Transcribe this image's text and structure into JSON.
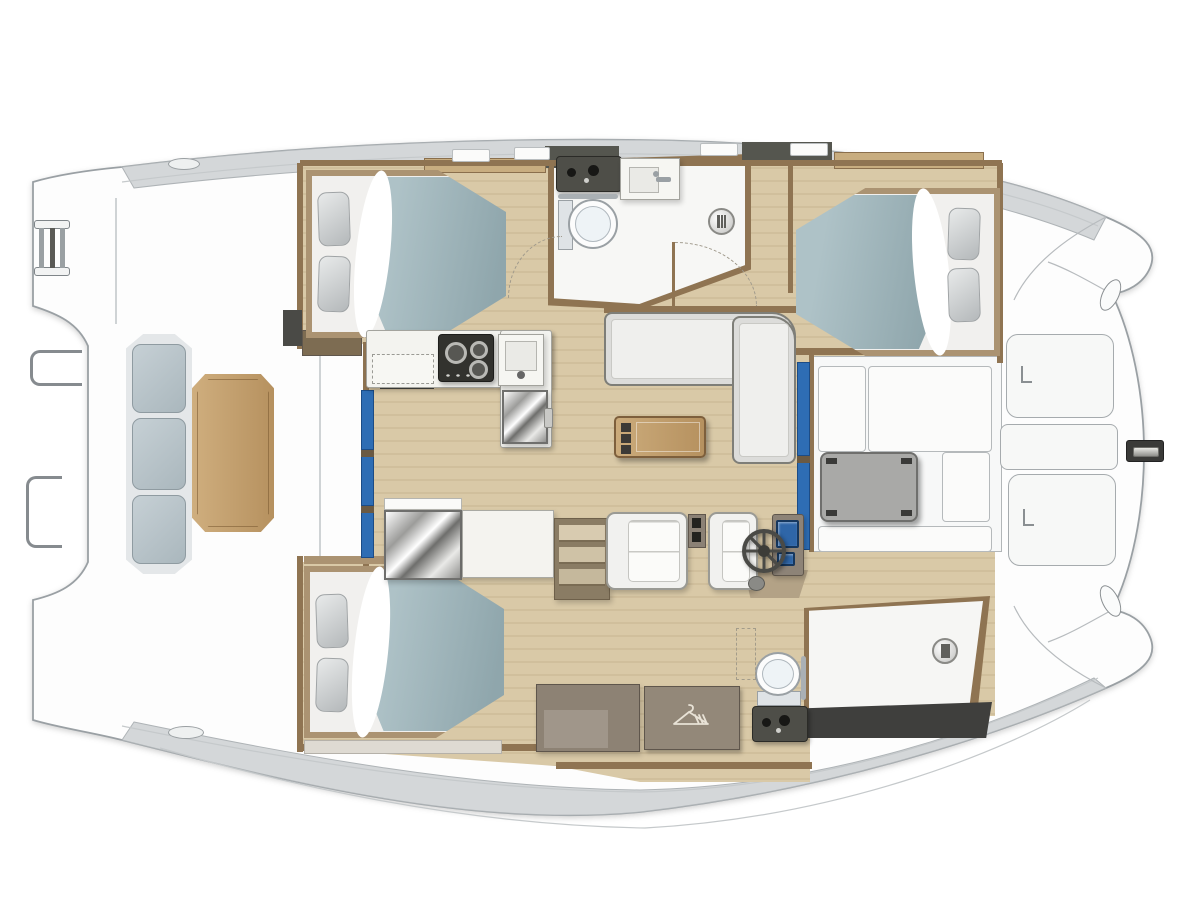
{
  "palette": {
    "page_bg": "#ffffff",
    "hull_fill": "#fdfdfd",
    "hull_stroke": "#9aa0a4",
    "band": "#d4d7d9",
    "band_stroke": "#aeb3b6",
    "deck_line": "#c5c9cb",
    "wood_a": "#d9c9a7",
    "wood_b": "#d0bf9c",
    "trim": "#8f7452",
    "trim_dark": "#6b5a43",
    "counter": "#f3f3ef",
    "blue_door": "#2e6db4",
    "blue_door_dark": "#1c4c86",
    "duvet_l": "#aec2c7",
    "duvet_d": "#8fa6ac",
    "mattress": "#f1f0ee",
    "bed_trim": "#ab9372",
    "pillow_l": "#e8eaea",
    "pillow_d": "#b4b8ba",
    "sofa": "#efefed",
    "woodtab_l": "#cfae7e",
    "woodtab_d": "#b6915f",
    "dark_fixture": "#3a3a38",
    "white_floor": "#f7f7f5",
    "speckle": "#e8e8e4"
  },
  "elements": [
    {
      "id": "salon-wood-floor",
      "t": "rect",
      "x": 0,
      "y": 0,
      "w": 1200,
      "h": 900,
      "cls": "wood",
      "z": 1,
      "clip": "polygon(300px 165px,1000px 165px,1000px 360px,814px 360px,814px 550px,995px 550px,995px 716px,810px 716px,810px 782px,640px 782px,556px 766px,300px 748px,300px 562px,366px 562px,366px 344px,300px 344px)"
    },
    {
      "id": "bathroom-wall",
      "t": "rect",
      "x": 548,
      "y": 154,
      "w": 203,
      "h": 156,
      "fill": "#8f7452",
      "z": 2,
      "clip": "polygon(0 4%,100% 0,100% 74%,45% 100%,0 97%)"
    },
    {
      "id": "bathroom-floor",
      "t": "rect",
      "x": 553,
      "y": 160,
      "w": 192,
      "h": 144,
      "fill": "#f7f7f5",
      "cls": "speckle",
      "z": 3,
      "clip": "polygon(0 3%,100% 0,100% 73%,45% 100%,0 96%)"
    },
    {
      "id": "bow-cockpit-floor",
      "t": "rect",
      "x": 812,
      "y": 356,
      "w": 190,
      "h": 196,
      "fill": "#f7f8f8",
      "stroke": "#b2b6b8",
      "cls": "speckle",
      "z": 2
    },
    {
      "id": "shower-wall",
      "t": "rect",
      "x": 804,
      "y": 596,
      "w": 186,
      "h": 120,
      "fill": "#8f7452",
      "z": 2,
      "clip": "polygon(0 10%,100% 0,93% 100%,0 100%)"
    },
    {
      "id": "shower-floor",
      "t": "rect",
      "x": 809,
      "y": 601,
      "w": 174,
      "h": 108,
      "fill": "#f6f6f4",
      "cls": "speckle",
      "z": 3,
      "clip": "polygon(0 9%,100% 0,92% 100%,0 100%)"
    },
    {
      "id": "wall-top",
      "t": "rect",
      "x": 300,
      "y": 160,
      "w": 702,
      "h": 6,
      "fill": "#8f7452",
      "z": 4
    },
    {
      "id": "wall-left-fwd",
      "t": "rect",
      "x": 297,
      "y": 163,
      "w": 6,
      "h": 186,
      "fill": "#8f7452",
      "z": 4
    },
    {
      "id": "wall-left-mid",
      "t": "rect",
      "x": 363,
      "y": 342,
      "w": 6,
      "h": 224,
      "fill": "#8f7452",
      "z": 4
    },
    {
      "id": "wall-left-aft",
      "t": "rect",
      "x": 297,
      "y": 556,
      "w": 6,
      "h": 196,
      "fill": "#8f7452",
      "z": 4
    },
    {
      "id": "wall-right-cabin",
      "t": "rect",
      "x": 997,
      "y": 163,
      "w": 6,
      "h": 200,
      "fill": "#8f7452",
      "z": 4
    },
    {
      "id": "wall-bath-left",
      "t": "rect",
      "x": 549,
      "y": 163,
      "w": 5,
      "h": 140,
      "fill": "#8f7452",
      "z": 4
    },
    {
      "id": "wall-sofa-back",
      "t": "rect",
      "x": 604,
      "y": 306,
      "w": 194,
      "h": 7,
      "fill": "#8f7452",
      "z": 4
    },
    {
      "id": "wall-cockpit-left",
      "t": "rect",
      "x": 809,
      "y": 354,
      "w": 5,
      "h": 198,
      "fill": "#8f7452",
      "z": 4
    },
    {
      "id": "wall-corridor-right",
      "t": "rect",
      "x": 788,
      "y": 163,
      "w": 5,
      "h": 130,
      "fill": "#8f7452",
      "z": 4
    },
    {
      "id": "wall-under-stbd-bed",
      "t": "rect",
      "x": 793,
      "y": 348,
      "w": 209,
      "h": 7,
      "fill": "#8f7452",
      "z": 4
    },
    {
      "id": "wall-bottom-port",
      "t": "rect",
      "x": 300,
      "y": 744,
      "w": 260,
      "h": 7,
      "fill": "#8f7452",
      "z": 4
    },
    {
      "id": "wall-bottom-mid",
      "t": "rect",
      "x": 556,
      "y": 762,
      "w": 256,
      "h": 7,
      "fill": "#8f7452",
      "z": 4
    },
    {
      "id": "wall-aft-bed-head",
      "t": "rect",
      "x": 304,
      "y": 556,
      "w": 200,
      "h": 8,
      "fill": "#ab9372",
      "z": 4
    },
    {
      "id": "cabinet-by-galley",
      "t": "rect",
      "x": 302,
      "y": 330,
      "w": 60,
      "h": 26,
      "fill": "#7d6c52",
      "stroke": "#5f564c",
      "z": 5
    },
    {
      "id": "oven-front",
      "t": "rect",
      "x": 380,
      "y": 378,
      "w": 54,
      "h": 11,
      "fill": "#45453f",
      "z": 5
    },
    {
      "id": "companionway-dark",
      "t": "rect",
      "x": 283,
      "y": 310,
      "w": 19,
      "h": 36,
      "fill": "#4a4a46",
      "z": 4
    },
    {
      "id": "deck-seam-1",
      "t": "rect",
      "x": 319,
      "y": 334,
      "w": 2,
      "h": 226,
      "fill": "#cfd3d5",
      "z": 1
    },
    {
      "id": "deck-seam-2",
      "t": "rect",
      "x": 115,
      "y": 198,
      "w": 2,
      "h": 126,
      "fill": "#cfd3d5",
      "z": 1
    },
    {
      "id": "sliding-door-port-1",
      "t": "rect",
      "x": 361,
      "y": 390,
      "w": 13,
      "h": 60,
      "fill": "#2e6db4",
      "stroke": "#1c4c86",
      "z": 5
    },
    {
      "id": "sliding-door-port-2",
      "t": "rect",
      "x": 361,
      "y": 456,
      "w": 13,
      "h": 50,
      "fill": "#2e6db4",
      "stroke": "#1c4c86",
      "z": 5
    },
    {
      "id": "sliding-door-port-3",
      "t": "rect",
      "x": 361,
      "y": 512,
      "w": 13,
      "h": 46,
      "fill": "#2e6db4",
      "stroke": "#1c4c86",
      "z": 5
    },
    {
      "id": "door-sep-1",
      "t": "rect",
      "x": 361,
      "y": 450,
      "w": 13,
      "h": 7,
      "fill": "#6b5a43",
      "z": 6
    },
    {
      "id": "door-sep-2",
      "t": "rect",
      "x": 361,
      "y": 506,
      "w": 13,
      "h": 7,
      "fill": "#6b5a43",
      "z": 6
    },
    {
      "id": "sliding-door-stbd-1",
      "t": "rect",
      "x": 797,
      "y": 362,
      "w": 13,
      "h": 94,
      "fill": "#2e6db4",
      "stroke": "#1c4c86",
      "z": 5
    },
    {
      "id": "sliding-door-stbd-2",
      "t": "rect",
      "x": 797,
      "y": 462,
      "w": 13,
      "h": 88,
      "fill": "#2e6db4",
      "stroke": "#1c4c86",
      "z": 5
    },
    {
      "id": "door-sep-3",
      "t": "rect",
      "x": 797,
      "y": 456,
      "w": 13,
      "h": 7,
      "fill": "#6b5a43",
      "z": 6
    },
    {
      "id": "roof-dark-seg-1",
      "t": "rect",
      "x": 545,
      "y": 146,
      "w": 74,
      "h": 22,
      "fill": "#55564f",
      "z": 3
    },
    {
      "id": "roof-dark-seg-2",
      "t": "rect",
      "x": 742,
      "y": 142,
      "w": 90,
      "h": 22,
      "fill": "#55564f",
      "z": 3
    },
    {
      "id": "roof-tan-seg-1",
      "t": "rect",
      "x": 424,
      "y": 158,
      "w": 122,
      "h": 15,
      "fill": "#c8ad80",
      "stroke": "#8a6f4d",
      "z": 3
    },
    {
      "id": "roof-tan-seg-2",
      "t": "rect",
      "x": 834,
      "y": 152,
      "w": 150,
      "h": 17,
      "fill": "#c8ad80",
      "stroke": "#8a6f4d",
      "z": 3
    },
    {
      "id": "roof-hatch-1",
      "t": "rect",
      "x": 452,
      "y": 149,
      "w": 38,
      "h": 13,
      "fill": "#fbfbfa",
      "stroke": "#b9bdbf",
      "r": 2,
      "z": 4
    },
    {
      "id": "roof-hatch-2",
      "t": "rect",
      "x": 514,
      "y": 147,
      "w": 36,
      "h": 13,
      "fill": "#fbfbfa",
      "stroke": "#b9bdbf",
      "r": 2,
      "z": 4
    },
    {
      "id": "roof-hatch-3",
      "t": "rect",
      "x": 700,
      "y": 143,
      "w": 38,
      "h": 13,
      "fill": "#fbfbfa",
      "stroke": "#b9bdbf",
      "r": 2,
      "z": 4
    },
    {
      "id": "roof-hatch-4",
      "t": "rect",
      "x": 790,
      "y": 143,
      "w": 38,
      "h": 13,
      "fill": "#fbfbfa",
      "stroke": "#b9bdbf",
      "r": 2,
      "z": 4
    },
    {
      "id": "cleat-aft-top",
      "t": "oval",
      "x": 168,
      "y": 158,
      "w": 32,
      "h": 12,
      "fill": "#eef0f0",
      "stroke": "#9a9fa2",
      "z": 4
    },
    {
      "id": "cleat-aft-bottom",
      "t": "oval",
      "x": 168,
      "y": 726,
      "w": 36,
      "h": 13,
      "fill": "#eef0f0",
      "stroke": "#9a9fa2",
      "z": 4
    },
    {
      "id": "scupper-bow-top",
      "t": "oval",
      "x": 1102,
      "y": 278,
      "w": 17,
      "h": 34,
      "fill": "#fafbfb",
      "stroke": "#8a8f92",
      "rot": 26,
      "z": 4
    },
    {
      "id": "scupper-bow-bottom",
      "t": "oval",
      "x": 1102,
      "y": 584,
      "w": 17,
      "h": 34,
      "fill": "#fafbfb",
      "stroke": "#8a8f92",
      "rot": -26,
      "z": 4
    },
    {
      "id": "bed-forward-port",
      "t": "bed",
      "x": 306,
      "y": 170,
      "w": 200,
      "h": 168,
      "dir": "right",
      "z": 5
    },
    {
      "id": "pillow-fp-1",
      "t": "pillow",
      "x": 318,
      "y": 192,
      "w": 32,
      "h": 54,
      "rot": -2,
      "z": 6
    },
    {
      "id": "pillow-fp-2",
      "t": "pillow",
      "x": 318,
      "y": 256,
      "w": 32,
      "h": 56,
      "rot": 2,
      "z": 6
    },
    {
      "id": "bed-forward-stbd",
      "t": "bed",
      "x": 796,
      "y": 188,
      "w": 204,
      "h": 168,
      "dir": "left",
      "z": 5
    },
    {
      "id": "pillow-fs-1",
      "t": "pillow",
      "x": 948,
      "y": 208,
      "w": 32,
      "h": 52,
      "rot": 2,
      "z": 6
    },
    {
      "id": "pillow-fs-2",
      "t": "pillow",
      "x": 948,
      "y": 268,
      "w": 32,
      "h": 54,
      "rot": -2,
      "z": 6
    },
    {
      "id": "bed-aft-port",
      "t": "bed",
      "x": 304,
      "y": 566,
      "w": 200,
      "h": 172,
      "dir": "right",
      "z": 5
    },
    {
      "id": "pillow-ap-1",
      "t": "pillow",
      "x": 316,
      "y": 594,
      "w": 32,
      "h": 54,
      "rot": -2,
      "z": 6
    },
    {
      "id": "pillow-ap-2",
      "t": "pillow",
      "x": 316,
      "y": 658,
      "w": 32,
      "h": 54,
      "rot": 2,
      "z": 6
    },
    {
      "id": "shelf-aft-port",
      "t": "rect",
      "x": 304,
      "y": 740,
      "w": 198,
      "h": 14,
      "fill": "#dedad2",
      "stroke": "#b5b1a9",
      "z": 4
    },
    {
      "id": "galley-counter",
      "t": "rect",
      "x": 366,
      "y": 330,
      "w": 186,
      "h": 58,
      "fill": "#f3f3ef",
      "stroke": "#a3a39d",
      "r": 3,
      "cls": "shadow",
      "z": 5
    },
    {
      "id": "galley-counter-return",
      "t": "rect",
      "x": 500,
      "y": 330,
      "w": 52,
      "h": 118,
      "fill": "#f3f3ef",
      "stroke": "#a3a39d",
      "r": 3,
      "cls": "shadow",
      "z": 5
    },
    {
      "id": "galley-worktop-dashed",
      "t": "rect",
      "x": 372,
      "y": 354,
      "w": 62,
      "h": 30,
      "fill": "#f7f7f3",
      "stroke": "#9a9a94",
      "dash": true,
      "z": 6
    },
    {
      "id": "galley-stove",
      "t": "stove",
      "x": 438,
      "y": 334,
      "w": 56,
      "h": 48,
      "z": 6
    },
    {
      "id": "galley-sink",
      "t": "sink",
      "x": 498,
      "y": 334,
      "w": 46,
      "h": 52,
      "variant": "galley",
      "z": 6
    },
    {
      "id": "galley-fridge",
      "t": "fridge",
      "x": 502,
      "y": 390,
      "w": 46,
      "h": 54,
      "z": 6
    },
    {
      "id": "salon-sofa-long",
      "t": "sofa",
      "x": 604,
      "y": 312,
      "w": 192,
      "h": 74,
      "orient": "h",
      "z": 5
    },
    {
      "id": "salon-sofa-short",
      "t": "sofa",
      "x": 732,
      "y": 316,
      "w": 64,
      "h": 148,
      "orient": "v",
      "z": 5
    },
    {
      "id": "salon-coffee-table",
      "t": "cofftable",
      "x": 614,
      "y": 416,
      "w": 92,
      "h": 42,
      "z": 6
    },
    {
      "id": "sideboard-top",
      "t": "rect",
      "x": 384,
      "y": 498,
      "w": 78,
      "h": 12,
      "fill": "#fafaf8",
      "stroke": "#b5b5b0",
      "z": 5
    },
    {
      "id": "sideboard-mirror",
      "t": "rect",
      "x": 384,
      "y": 510,
      "w": 78,
      "h": 70,
      "cls": "metallic shadow",
      "z": 5
    },
    {
      "id": "sideboard-counter",
      "t": "rect",
      "x": 462,
      "y": 510,
      "w": 92,
      "h": 68,
      "fill": "#f4f3ef",
      "stroke": "#a9a9a3",
      "cls": "shadow",
      "z": 5
    },
    {
      "id": "companionway-stairs",
      "t": "stairs",
      "x": 554,
      "y": 518,
      "w": 56,
      "h": 82,
      "z": 5
    },
    {
      "id": "helm-base",
      "t": "rect",
      "x": 744,
      "y": 570,
      "w": 64,
      "h": 28,
      "fill": "#b3a286",
      "z": 5,
      "clip": "polygon(0 0,100% 0,86% 100%,10% 100%)"
    },
    {
      "id": "helm-seat",
      "t": "seat",
      "x": 606,
      "y": 512,
      "w": 82,
      "h": 78,
      "z": 5
    },
    {
      "id": "helm-drawers",
      "t": "drawers",
      "x": 688,
      "y": 514,
      "w": 18,
      "h": 34,
      "z": 6
    },
    {
      "id": "helm-bench",
      "t": "seat",
      "x": 708,
      "y": 512,
      "w": 50,
      "h": 78,
      "z": 5
    },
    {
      "id": "helm-console",
      "t": "rect",
      "x": 772,
      "y": 514,
      "w": 32,
      "h": 62,
      "fill": "#8d8377",
      "stroke": "#5f564c",
      "r": 3,
      "cls": "shadow",
      "z": 6
    },
    {
      "id": "helm-screen-main",
      "t": "screen",
      "x": 776,
      "y": 520,
      "w": 23,
      "h": 28,
      "z": 7
    },
    {
      "id": "helm-screen-small",
      "t": "screen",
      "x": 777,
      "y": 552,
      "w": 18,
      "h": 14,
      "z": 7
    },
    {
      "id": "helm-wheel",
      "t": "wheel",
      "x": 742,
      "y": 529,
      "w": 44,
      "h": 44,
      "z": 7
    },
    {
      "id": "helm-compass",
      "t": "oval",
      "x": 748,
      "y": 576,
      "w": 17,
      "h": 15,
      "fill": "#8a8a86",
      "stroke": "#5a5a56",
      "z": 7
    },
    {
      "id": "aft-cabinet",
      "t": "rect",
      "x": 536,
      "y": 684,
      "w": 104,
      "h": 68,
      "fill": "#8d8274",
      "stroke": "#5f564c",
      "cls": "shadow",
      "z": 5
    },
    {
      "id": "aft-cabinet-inset",
      "t": "rect",
      "x": 544,
      "y": 710,
      "w": 64,
      "h": 38,
      "fill": "#a0968a",
      "z": 6
    },
    {
      "id": "hanging-locker",
      "t": "hanger",
      "x": 644,
      "y": 686,
      "w": 96,
      "h": 64,
      "z": 5
    },
    {
      "id": "aft-toilet",
      "t": "toilet",
      "x": 754,
      "y": 650,
      "w": 48,
      "h": 56,
      "orient": "v",
      "z": 6
    },
    {
      "id": "aft-towel-bar",
      "t": "rect",
      "x": 801,
      "y": 656,
      "w": 5,
      "h": 44,
      "fill": "#aab0b4",
      "r": 3,
      "z": 6
    },
    {
      "id": "aft-vanity",
      "t": "vanity",
      "x": 752,
      "y": 706,
      "w": 56,
      "h": 36,
      "z": 6
    },
    {
      "id": "hatch-arrow-dashed",
      "t": "rect",
      "x": 736,
      "y": 628,
      "w": 20,
      "h": 52,
      "stroke": "#a39c8a",
      "dash": true,
      "z": 6
    },
    {
      "id": "shower-drain-aft",
      "t": "drain",
      "x": 932,
      "y": 638,
      "w": 26,
      "h": 26,
      "z": 6
    },
    {
      "id": "transom-step-dark",
      "t": "rect",
      "x": 798,
      "y": 702,
      "w": 194,
      "h": 36,
      "fill": "#3f3f3d",
      "z": 4,
      "clip": "polygon(0 18%,100% 0,97% 100%,0 100%)"
    },
    {
      "id": "bow-seat-left",
      "t": "rect",
      "x": 818,
      "y": 366,
      "w": 48,
      "h": 86,
      "fill": "#fbfbfa",
      "stroke": "#b5b9bb",
      "r": 4,
      "z": 5
    },
    {
      "id": "bow-seat-top",
      "t": "rect",
      "x": 868,
      "y": 366,
      "w": 124,
      "h": 86,
      "fill": "#fbfbfa",
      "stroke": "#b5b9bb",
      "r": 4,
      "z": 5
    },
    {
      "id": "bow-table",
      "t": "cockpittable",
      "x": 820,
      "y": 452,
      "w": 98,
      "h": 70,
      "z": 6
    },
    {
      "id": "bow-seat-right",
      "t": "rect",
      "x": 942,
      "y": 452,
      "w": 48,
      "h": 70,
      "fill": "#fbfbfa",
      "stroke": "#b5b9bb",
      "r": 4,
      "z": 5
    },
    {
      "id": "bow-bench-bottom",
      "t": "rect",
      "x": 818,
      "y": 526,
      "w": 174,
      "h": 26,
      "fill": "#fbfbfa",
      "stroke": "#b5b9bb",
      "r": 4,
      "z": 5
    },
    {
      "id": "foredeck-hatch-top",
      "t": "hatch",
      "x": 1006,
      "y": 334,
      "w": 108,
      "h": 84,
      "z": 4
    },
    {
      "id": "foredeck-locker-mid",
      "t": "rect",
      "x": 1000,
      "y": 424,
      "w": 118,
      "h": 46,
      "fill": "#f7f8f7",
      "stroke": "#a6abae",
      "r": 8,
      "z": 4
    },
    {
      "id": "foredeck-hatch-bottom",
      "t": "hatch",
      "x": 1008,
      "y": 474,
      "w": 108,
      "h": 92,
      "z": 4
    },
    {
      "id": "anchor-windlass",
      "t": "windlass",
      "x": 1126,
      "y": 440,
      "w": 38,
      "h": 22,
      "z": 5
    },
    {
      "id": "cockpit-bench",
      "t": "bench",
      "x": 126,
      "y": 334,
      "w": 66,
      "h": 240,
      "z": 5
    },
    {
      "id": "cockpit-table",
      "t": "woodtable",
      "x": 192,
      "y": 374,
      "w": 82,
      "h": 158,
      "z": 6
    },
    {
      "id": "boarding-ladder",
      "t": "ladder",
      "x": 34,
      "y": 220,
      "w": 36,
      "h": 56,
      "z": 5
    },
    {
      "id": "stern-rail-upper",
      "t": "rail",
      "x": 30,
      "y": 350,
      "w": 52,
      "h": 36,
      "z": 5
    },
    {
      "id": "stern-rail-lower",
      "t": "rail",
      "x": 26,
      "y": 476,
      "w": 36,
      "h": 72,
      "z": 5
    },
    {
      "id": "bath-vanity",
      "t": "vanity",
      "x": 556,
      "y": 156,
      "w": 66,
      "h": 36,
      "z": 6
    },
    {
      "id": "bath-sink",
      "t": "sink",
      "x": 620,
      "y": 158,
      "w": 60,
      "h": 42,
      "variant": "bath",
      "z": 6
    },
    {
      "id": "bath-towel-bar",
      "t": "rect",
      "x": 558,
      "y": 194,
      "w": 60,
      "h": 5,
      "fill": "#aab0b4",
      "r": 3,
      "z": 6
    },
    {
      "id": "bath-toilet",
      "t": "toilet",
      "x": 558,
      "y": 198,
      "w": 62,
      "h": 52,
      "orient": "h",
      "z": 6
    },
    {
      "id": "shower-drain-fwd",
      "t": "drain",
      "x": 708,
      "y": 208,
      "w": 27,
      "h": 27,
      "z": 6
    },
    {
      "id": "bath-door-leaf",
      "t": "rect",
      "x": 672,
      "y": 242,
      "w": 3,
      "h": 64,
      "fill": "#8f7452",
      "z": 6
    },
    {
      "id": "bath-door-swing",
      "t": "arc",
      "x": 675,
      "y": 242,
      "w": 82,
      "h": 64,
      "corner": "tr",
      "z": 6
    },
    {
      "id": "cabin-door-swing",
      "t": "arc",
      "x": 508,
      "y": 236,
      "w": 54,
      "h": 62,
      "corner": "tl",
      "z": 6
    }
  ]
}
